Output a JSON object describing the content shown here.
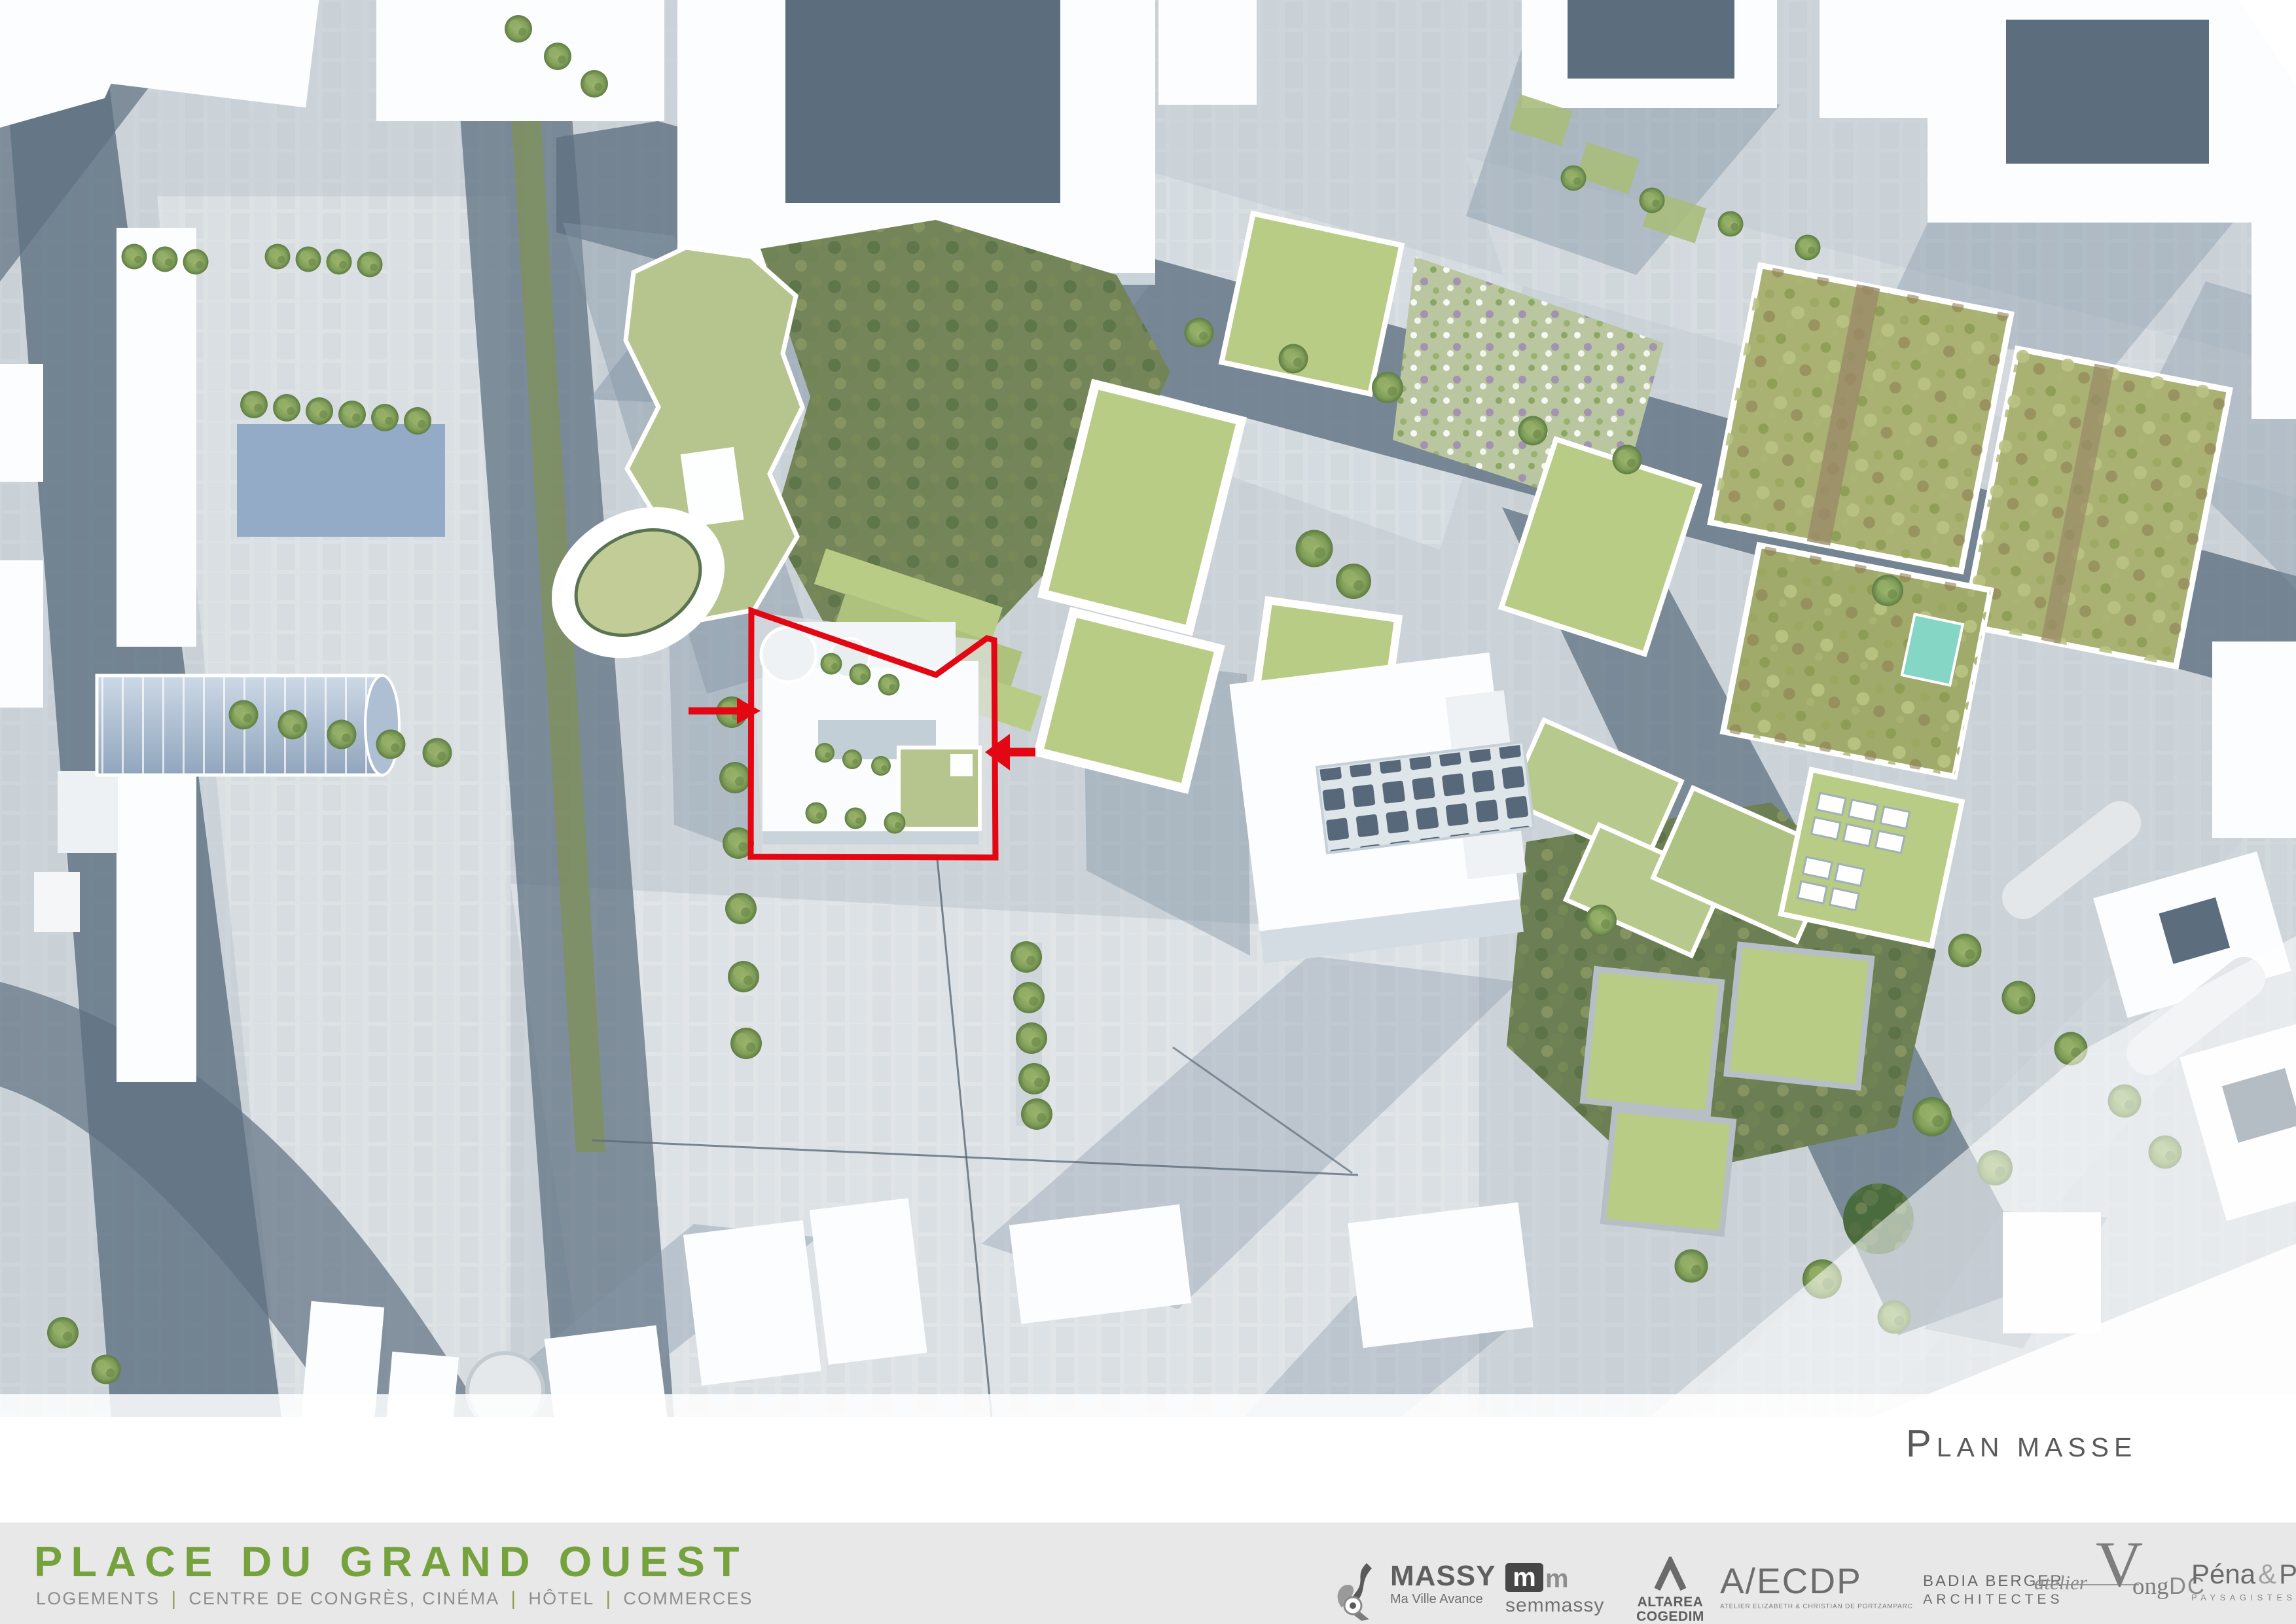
{
  "plan_label": {
    "initial": "P",
    "rest": "LAN MASSE"
  },
  "footer": {
    "title": "PLACE DU GRAND OUEST",
    "separator": "|",
    "services": [
      "LOGEMENTS",
      "CENTRE DE CONGRÈS, CINÉMA",
      "HÔTEL",
      "COMMERCES"
    ]
  },
  "logos": {
    "massy": {
      "name": "MASSY",
      "tagline": "Ma Ville Avance"
    },
    "semmassy": {
      "glyph1": "m",
      "glyph2": "m",
      "name": "semmassy"
    },
    "altarea": {
      "line1": "ALTAREA",
      "line2": "COGEDIM"
    },
    "aecdp": {
      "name": "A/ECDP",
      "caption": "ATELIER ELIZABETH & CHRISTIAN DE PORTZAMPARC"
    },
    "badia": {
      "line1": "BADIA BERGER",
      "line2": "ARCHITECTES"
    },
    "vong": {
      "script": "atelier",
      "initial": "V",
      "rest": "ong",
      "suffix": "DC"
    },
    "pena": {
      "part1": "Péna",
      "amp": "&",
      "part2": "Peña",
      "caption": "PAYSAGISTES DPLG"
    }
  },
  "map": {
    "caption": "Plan masse",
    "highlight": "red site boundary with entry arrows"
  },
  "colors": {
    "accent_red": "#e30613",
    "title_green": "#76a23e",
    "separator_green": "#8ba04f",
    "footer_bg": "#e8e8e8",
    "caption_gray": "#5a5a5a",
    "logo_gray": "#6a6a6a",
    "paving": "#ced5da",
    "plaza_light": "#e1e5e8",
    "road_dark": "#5f7181",
    "shadow_blue": "#8496a7",
    "building_white": "#fcfdfe",
    "green_roof": "#b6c48e",
    "lawn": "#b9cc85",
    "woods": "#75855a",
    "garden": "#a9b273",
    "pool_blue": "#93abc7",
    "glass_teal": "#86d6c6"
  }
}
